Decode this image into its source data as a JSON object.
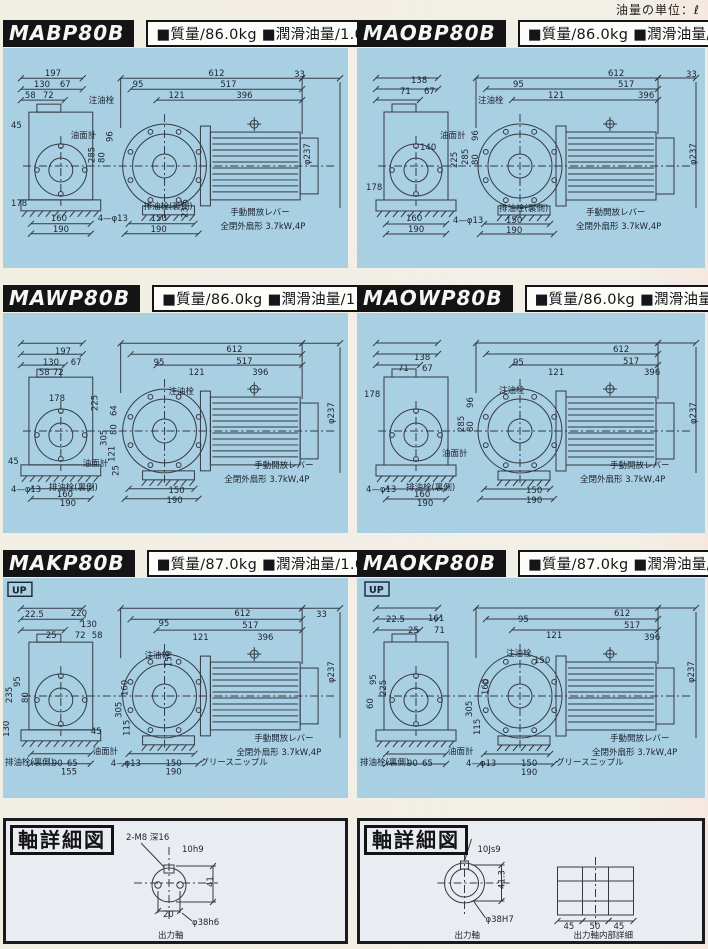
{
  "page": {
    "unit_note": "油量の単位：ℓ"
  },
  "colors": {
    "panel_bg": "#a9cfe2",
    "line": "#333a44",
    "label": "#1c2330",
    "header_bg": "#141417"
  },
  "panels": [
    {
      "model": "MABP80B",
      "specs": "■質量/86.0kg ■潤滑油量/1.0",
      "variant": "B",
      "labels": [
        {
          "t": "197",
          "x": 42,
          "y": 28
        },
        {
          "t": "130",
          "x": 31,
          "y": 39
        },
        {
          "t": "67",
          "x": 57,
          "y": 39
        },
        {
          "t": "58",
          "x": 22,
          "y": 50
        },
        {
          "t": "72",
          "x": 40,
          "y": 50
        },
        {
          "t": "45",
          "x": 8,
          "y": 80
        },
        {
          "t": "注油栓",
          "x": 86,
          "y": 55
        },
        {
          "t": "油面計",
          "x": 68,
          "y": 90
        },
        {
          "t": "95",
          "x": 130,
          "y": 39
        },
        {
          "t": "121",
          "x": 166,
          "y": 50
        },
        {
          "t": "612",
          "x": 206,
          "y": 28
        },
        {
          "t": "33",
          "x": 292,
          "y": 29
        },
        {
          "t": "517",
          "x": 218,
          "y": 39
        },
        {
          "t": "396",
          "x": 234,
          "y": 50
        },
        {
          "t": "285",
          "x": 92,
          "y": 115,
          "v": 1
        },
        {
          "t": "80",
          "x": 102,
          "y": 115,
          "v": 1
        },
        {
          "t": "96",
          "x": 110,
          "y": 94,
          "v": 1
        },
        {
          "t": "φ237",
          "x": 308,
          "y": 117,
          "v": 1
        },
        {
          "t": "178",
          "x": 8,
          "y": 158
        },
        {
          "t": "23.5",
          "x": 185,
          "y": 170,
          "v": 1
        },
        {
          "t": "160",
          "x": 48,
          "y": 173
        },
        {
          "t": "190",
          "x": 50,
          "y": 184
        },
        {
          "t": "4—φ13",
          "x": 95,
          "y": 173
        },
        {
          "t": "排油栓(裏側)",
          "x": 141,
          "y": 161
        },
        {
          "t": "150",
          "x": 148,
          "y": 173
        },
        {
          "t": "190",
          "x": 148,
          "y": 184
        },
        {
          "t": "手動開放レバー",
          "x": 228,
          "y": 167
        },
        {
          "t": "全閉外扇形 3.7kW,4P",
          "x": 218,
          "y": 181
        }
      ]
    },
    {
      "model": "MAOBP80B",
      "specs": "■質量/86.0kg ■潤滑油量/1.0",
      "variant": "B",
      "labels": [
        {
          "t": "138",
          "x": 53,
          "y": 35
        },
        {
          "t": "71",
          "x": 42,
          "y": 46
        },
        {
          "t": "67",
          "x": 66,
          "y": 46
        },
        {
          "t": "注油栓",
          "x": 120,
          "y": 55
        },
        {
          "t": "油面計",
          "x": 82,
          "y": 90
        },
        {
          "t": "140",
          "x": 62,
          "y": 102
        },
        {
          "t": "95",
          "x": 155,
          "y": 39
        },
        {
          "t": "121",
          "x": 190,
          "y": 50
        },
        {
          "t": "612",
          "x": 250,
          "y": 28
        },
        {
          "t": "33",
          "x": 328,
          "y": 29
        },
        {
          "t": "517",
          "x": 260,
          "y": 39
        },
        {
          "t": "396",
          "x": 280,
          "y": 50
        },
        {
          "t": "225",
          "x": 99,
          "y": 120,
          "v": 1
        },
        {
          "t": "285",
          "x": 110,
          "y": 117,
          "v": 1
        },
        {
          "t": "80",
          "x": 120,
          "y": 117,
          "v": 1
        },
        {
          "t": "96",
          "x": 120,
          "y": 93,
          "v": 1
        },
        {
          "t": "φ237",
          "x": 338,
          "y": 117,
          "v": 1
        },
        {
          "t": "178",
          "x": 8,
          "y": 142
        },
        {
          "t": "160",
          "x": 48,
          "y": 173
        },
        {
          "t": "190",
          "x": 50,
          "y": 184
        },
        {
          "t": "4—φ13",
          "x": 95,
          "y": 175
        },
        {
          "t": "排油栓(裏側)",
          "x": 141,
          "y": 163
        },
        {
          "t": "150",
          "x": 148,
          "y": 175
        },
        {
          "t": "190",
          "x": 148,
          "y": 185
        },
        {
          "t": "手動開放レバー",
          "x": 228,
          "y": 167
        },
        {
          "t": "全閉外扇形 3.7kW,4P",
          "x": 218,
          "y": 181
        }
      ]
    },
    {
      "model": "MAWP80B",
      "specs": "■質量/86.0kg ■潤滑油量/1.3",
      "variant": "W",
      "labels": [
        {
          "t": "197",
          "x": 52,
          "y": 41
        },
        {
          "t": "130",
          "x": 40,
          "y": 52
        },
        {
          "t": "67",
          "x": 68,
          "y": 52
        },
        {
          "t": "58",
          "x": 36,
          "y": 62
        },
        {
          "t": "72",
          "x": 50,
          "y": 62
        },
        {
          "t": "178",
          "x": 46,
          "y": 88
        },
        {
          "t": "225",
          "x": 95,
          "y": 98,
          "v": 1
        },
        {
          "t": "95",
          "x": 151,
          "y": 52
        },
        {
          "t": "121",
          "x": 186,
          "y": 62
        },
        {
          "t": "612",
          "x": 224,
          "y": 39
        },
        {
          "t": "517",
          "x": 234,
          "y": 51
        },
        {
          "t": "396",
          "x": 250,
          "y": 62
        },
        {
          "t": "注油栓",
          "x": 166,
          "y": 81
        },
        {
          "t": "64",
          "x": 114,
          "y": 103,
          "v": 1
        },
        {
          "t": "80",
          "x": 114,
          "y": 122,
          "v": 1
        },
        {
          "t": "305",
          "x": 104,
          "y": 133,
          "v": 1
        },
        {
          "t": "φ237",
          "x": 332,
          "y": 111,
          "v": 1
        },
        {
          "t": "45",
          "x": 5,
          "y": 151
        },
        {
          "t": "油面計",
          "x": 80,
          "y": 153
        },
        {
          "t": "121",
          "x": 112,
          "y": 149,
          "v": 1
        },
        {
          "t": "25",
          "x": 116,
          "y": 163,
          "v": 1
        },
        {
          "t": "4—φ13",
          "x": 8,
          "y": 179
        },
        {
          "t": "排油栓(裏側)",
          "x": 46,
          "y": 177
        },
        {
          "t": "160",
          "x": 54,
          "y": 184
        },
        {
          "t": "190",
          "x": 57,
          "y": 193
        },
        {
          "t": "150",
          "x": 166,
          "y": 180
        },
        {
          "t": "190",
          "x": 164,
          "y": 190
        },
        {
          "t": "手動開放レバー",
          "x": 252,
          "y": 155
        },
        {
          "t": "全閉外扇形 3.7kW,4P",
          "x": 222,
          "y": 169
        }
      ]
    },
    {
      "model": "MAOWP80B",
      "specs": "■質量/86.0kg ■潤滑油量/1.3",
      "variant": "W",
      "labels": [
        {
          "t": "138",
          "x": 56,
          "y": 47
        },
        {
          "t": "71",
          "x": 40,
          "y": 58
        },
        {
          "t": "67",
          "x": 64,
          "y": 58
        },
        {
          "t": "95",
          "x": 155,
          "y": 52
        },
        {
          "t": "121",
          "x": 190,
          "y": 62
        },
        {
          "t": "612",
          "x": 255,
          "y": 39
        },
        {
          "t": "517",
          "x": 265,
          "y": 51
        },
        {
          "t": "396",
          "x": 286,
          "y": 62
        },
        {
          "t": "注油栓",
          "x": 141,
          "y": 80
        },
        {
          "t": "178",
          "x": 6,
          "y": 84
        },
        {
          "t": "φ237",
          "x": 338,
          "y": 111,
          "v": 1
        },
        {
          "t": "285",
          "x": 106,
          "y": 119,
          "v": 1
        },
        {
          "t": "80",
          "x": 115,
          "y": 119,
          "v": 1
        },
        {
          "t": "96",
          "x": 115,
          "y": 95,
          "v": 1
        },
        {
          "t": "油面計",
          "x": 84,
          "y": 143
        },
        {
          "t": "4—φ13",
          "x": 8,
          "y": 179
        },
        {
          "t": "排油栓(裏側)",
          "x": 48,
          "y": 177
        },
        {
          "t": "160",
          "x": 56,
          "y": 184
        },
        {
          "t": "190",
          "x": 59,
          "y": 193
        },
        {
          "t": "150",
          "x": 168,
          "y": 180
        },
        {
          "t": "190",
          "x": 168,
          "y": 190
        },
        {
          "t": "手動開放レバー",
          "x": 252,
          "y": 155
        },
        {
          "t": "全閉外扇形 3.7kW,4P",
          "x": 222,
          "y": 169
        }
      ]
    },
    {
      "model": "MAKP80B",
      "specs": "■質量/87.0kg ■潤滑油量/1.0",
      "variant": "K",
      "labels": [
        {
          "t": "UP",
          "x": 8,
          "y": 14,
          "box": 1
        },
        {
          "t": "22.5",
          "x": 22,
          "y": 39
        },
        {
          "t": "220",
          "x": 68,
          "y": 38
        },
        {
          "t": "130",
          "x": 78,
          "y": 49
        },
        {
          "t": "25",
          "x": 43,
          "y": 60
        },
        {
          "t": "72",
          "x": 72,
          "y": 60
        },
        {
          "t": "58",
          "x": 89,
          "y": 60
        },
        {
          "t": "95",
          "x": 156,
          "y": 48
        },
        {
          "t": "121",
          "x": 190,
          "y": 62
        },
        {
          "t": "612",
          "x": 232,
          "y": 38
        },
        {
          "t": "33",
          "x": 314,
          "y": 39
        },
        {
          "t": "517",
          "x": 240,
          "y": 50
        },
        {
          "t": "396",
          "x": 255,
          "y": 62
        },
        {
          "t": "注油栓",
          "x": 142,
          "y": 80
        },
        {
          "t": "150",
          "x": 169,
          "y": 89,
          "v": 1
        },
        {
          "t": "95",
          "x": 17,
          "y": 109,
          "v": 1
        },
        {
          "t": "235",
          "x": 9,
          "y": 125,
          "v": 1
        },
        {
          "t": "80",
          "x": 25,
          "y": 125,
          "v": 1
        },
        {
          "t": "130",
          "x": 6,
          "y": 159,
          "v": 1
        },
        {
          "t": "160",
          "x": 125,
          "y": 118,
          "v": 1
        },
        {
          "t": "305",
          "x": 119,
          "y": 140,
          "v": 1
        },
        {
          "t": "115",
          "x": 127,
          "y": 158,
          "v": 1
        },
        {
          "t": "φ237",
          "x": 332,
          "y": 105,
          "v": 1
        },
        {
          "t": "45",
          "x": 88,
          "y": 156
        },
        {
          "t": "油面計",
          "x": 90,
          "y": 176
        },
        {
          "t": "排油栓(裏側)",
          "x": 2,
          "y": 187
        },
        {
          "t": "90",
          "x": 49,
          "y": 188
        },
        {
          "t": "65",
          "x": 64,
          "y": 188
        },
        {
          "t": "155",
          "x": 58,
          "y": 197
        },
        {
          "t": "4—φ13",
          "x": 108,
          "y": 188
        },
        {
          "t": "150",
          "x": 163,
          "y": 188
        },
        {
          "t": "190",
          "x": 163,
          "y": 197
        },
        {
          "t": "グリースニップル",
          "x": 198,
          "y": 187
        },
        {
          "t": "手動開放レバー",
          "x": 252,
          "y": 163
        },
        {
          "t": "全閉外扇形 3.7kW,4P",
          "x": 234,
          "y": 177
        }
      ]
    },
    {
      "model": "MAOKP80B",
      "specs": "■質量/87.0kg ■潤滑油量/1.0",
      "variant": "K",
      "labels": [
        {
          "t": "UP",
          "x": 10,
          "y": 14,
          "box": 1
        },
        {
          "t": "22.5",
          "x": 28,
          "y": 44
        },
        {
          "t": "161",
          "x": 70,
          "y": 43
        },
        {
          "t": "25",
          "x": 50,
          "y": 55
        },
        {
          "t": "71",
          "x": 76,
          "y": 55
        },
        {
          "t": "95",
          "x": 160,
          "y": 44
        },
        {
          "t": "121",
          "x": 188,
          "y": 60
        },
        {
          "t": "612",
          "x": 256,
          "y": 38
        },
        {
          "t": "517",
          "x": 266,
          "y": 50
        },
        {
          "t": "396",
          "x": 286,
          "y": 62
        },
        {
          "t": "注油栓",
          "x": 148,
          "y": 78
        },
        {
          "t": "150",
          "x": 176,
          "y": 85
        },
        {
          "t": "95",
          "x": 18,
          "y": 107,
          "v": 1
        },
        {
          "t": "225",
          "x": 28,
          "y": 118,
          "v": 1
        },
        {
          "t": "60",
          "x": 15,
          "y": 131,
          "v": 1
        },
        {
          "t": "160",
          "x": 130,
          "y": 117,
          "v": 1
        },
        {
          "t": "305",
          "x": 114,
          "y": 139,
          "v": 1
        },
        {
          "t": "115",
          "x": 122,
          "y": 157,
          "v": 1
        },
        {
          "t": "φ237",
          "x": 336,
          "y": 105,
          "v": 1
        },
        {
          "t": "油面計",
          "x": 90,
          "y": 176
        },
        {
          "t": "排油栓(裏側)",
          "x": 2,
          "y": 187
        },
        {
          "t": "90",
          "x": 49,
          "y": 188
        },
        {
          "t": "65",
          "x": 64,
          "y": 188
        },
        {
          "t": "4—φ13",
          "x": 108,
          "y": 188
        },
        {
          "t": "150",
          "x": 163,
          "y": 188
        },
        {
          "t": "190",
          "x": 163,
          "y": 197
        },
        {
          "t": "グリースニップル",
          "x": 198,
          "y": 187
        },
        {
          "t": "手動開放レバー",
          "x": 252,
          "y": 163
        },
        {
          "t": "全閉外扇形 3.7kW,4P",
          "x": 234,
          "y": 177
        }
      ]
    }
  ],
  "shaft_detail": [
    {
      "title": "軸詳細図",
      "type": "output_shaft_face",
      "labels": [
        {
          "t": "2-M8 深16",
          "x": 120,
          "y": 19
        },
        {
          "t": "10h9",
          "x": 176,
          "y": 31
        },
        {
          "t": "41",
          "x": 207,
          "y": 66,
          "v": 1
        },
        {
          "t": "20",
          "x": 157,
          "y": 96
        },
        {
          "t": "φ38h6",
          "x": 186,
          "y": 104
        },
        {
          "t": "出力軸",
          "x": 152,
          "y": 117
        }
      ]
    },
    {
      "title": "軸詳細図",
      "type": "hollow_shaft_section",
      "labels": [
        {
          "t": "10Js9",
          "x": 116,
          "y": 31
        },
        {
          "t": "41.3",
          "x": 143,
          "y": 68,
          "v": 1
        },
        {
          "t": "φ38H7",
          "x": 124,
          "y": 101
        },
        {
          "t": "出力軸",
          "x": 93,
          "y": 117
        },
        {
          "t": "45",
          "x": 202,
          "y": 108
        },
        {
          "t": "50",
          "x": 228,
          "y": 108
        },
        {
          "t": "45",
          "x": 252,
          "y": 108
        },
        {
          "t": "出力軸内部詳細",
          "x": 212,
          "y": 117
        }
      ]
    }
  ]
}
